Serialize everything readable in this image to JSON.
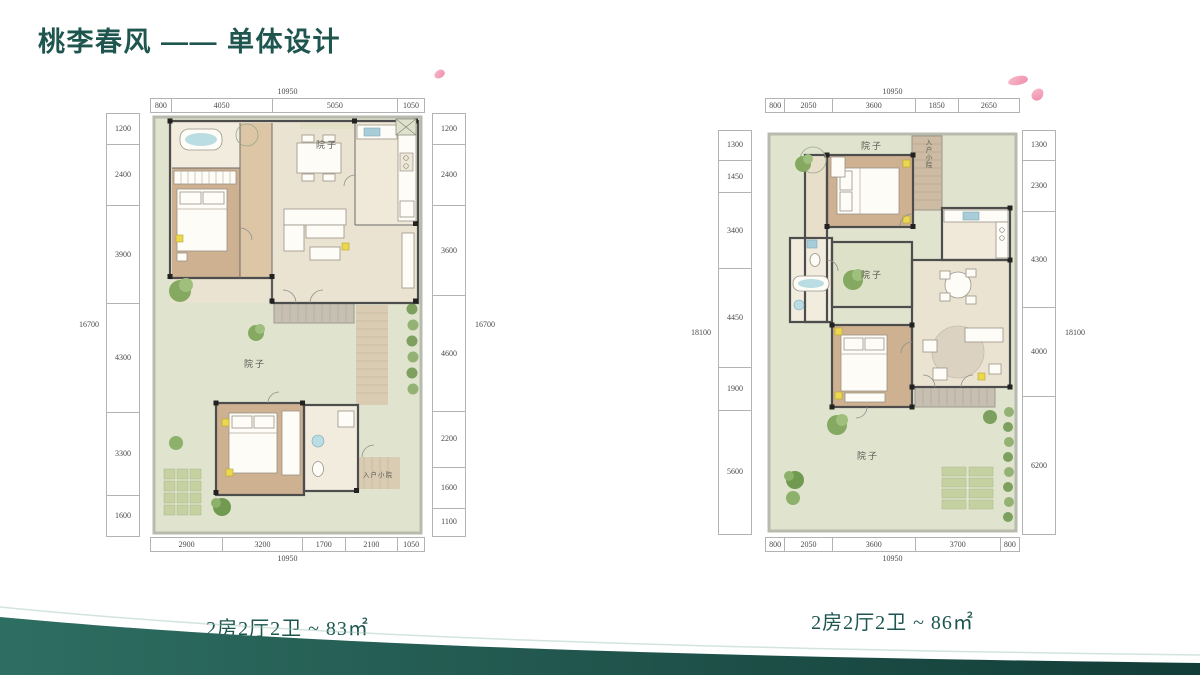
{
  "slide": {
    "title": "桃李春风 —— 单体设计",
    "accent_color": "#1e564f"
  },
  "plans": [
    {
      "caption": "2房2厅2卫 ~ 83㎡",
      "labels": {
        "yard_top": "院子",
        "yard_mid": "院子",
        "entry_yard": "入户小院"
      },
      "dims": {
        "top": {
          "total": "10950",
          "segments": [
            "800",
            "4050",
            "5050",
            "1050"
          ]
        },
        "bottom": {
          "total": "10950",
          "segments": [
            "2900",
            "3200",
            "1700",
            "2100",
            "1050"
          ]
        },
        "left": {
          "total": "16700",
          "segments": [
            "1200",
            "2400",
            "3900",
            "4300",
            "3300",
            "1600"
          ]
        },
        "right": {
          "total": "16700",
          "segments": [
            "1200",
            "2400",
            "3600",
            "4600",
            "2200",
            "1600",
            "1100"
          ]
        }
      }
    },
    {
      "caption": "2房2厅2卫 ~ 86㎡",
      "labels": {
        "yard_top": "院子",
        "entry_yard": "入户小院",
        "yard_mid": "院子",
        "yard_bottom": "院子"
      },
      "dims": {
        "top": {
          "total": "10950",
          "segments": [
            "800",
            "2050",
            "3600",
            "1850",
            "2650"
          ]
        },
        "bottom": {
          "total": "10950",
          "segments": [
            "800",
            "2050",
            "3600",
            "3700",
            "800"
          ]
        },
        "left": {
          "total": "18100",
          "segments": [
            "1300",
            "1450",
            "3400",
            "4450",
            "1900",
            "5600"
          ]
        },
        "right": {
          "total": "18100",
          "segments": [
            "1300",
            "2300",
            "4300",
            "4000",
            "6200"
          ]
        }
      }
    }
  ]
}
